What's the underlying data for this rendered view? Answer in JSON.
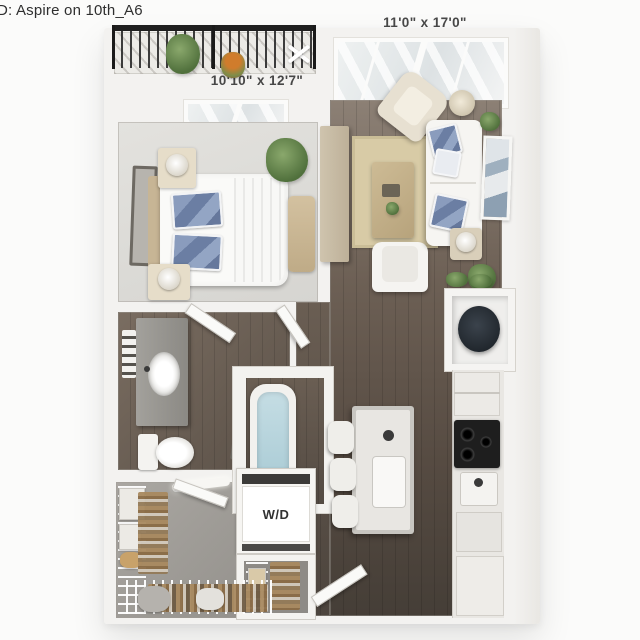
{
  "title": "D: Aspire on 10th_A6",
  "floorplan": {
    "living_dim": "11'0\" x 17'0\"",
    "bedroom_dim": "10'10\" x 12'7\"",
    "washer_dryer_label": "W/D"
  },
  "palette": {
    "background": "#fbfbfa",
    "wall": "#f3f2f0",
    "wood_floor_light": "#8c8075",
    "wood_floor_dark": "#453e37",
    "bedroom_carpet": "#dcdbd7",
    "closet_carpet": "#9d9a95",
    "balcony_floor": "#ecebe7",
    "railing": "#1f1f1f",
    "rug": "#d8cba6",
    "tub_water": "#b8d5de",
    "pillow_blue": "#6b7ea3",
    "plant_green": "#5f7e48",
    "cooktop_black": "#1e1e1e",
    "vanity_gray": "#96948f",
    "text_dark": "#2f2f2f"
  }
}
